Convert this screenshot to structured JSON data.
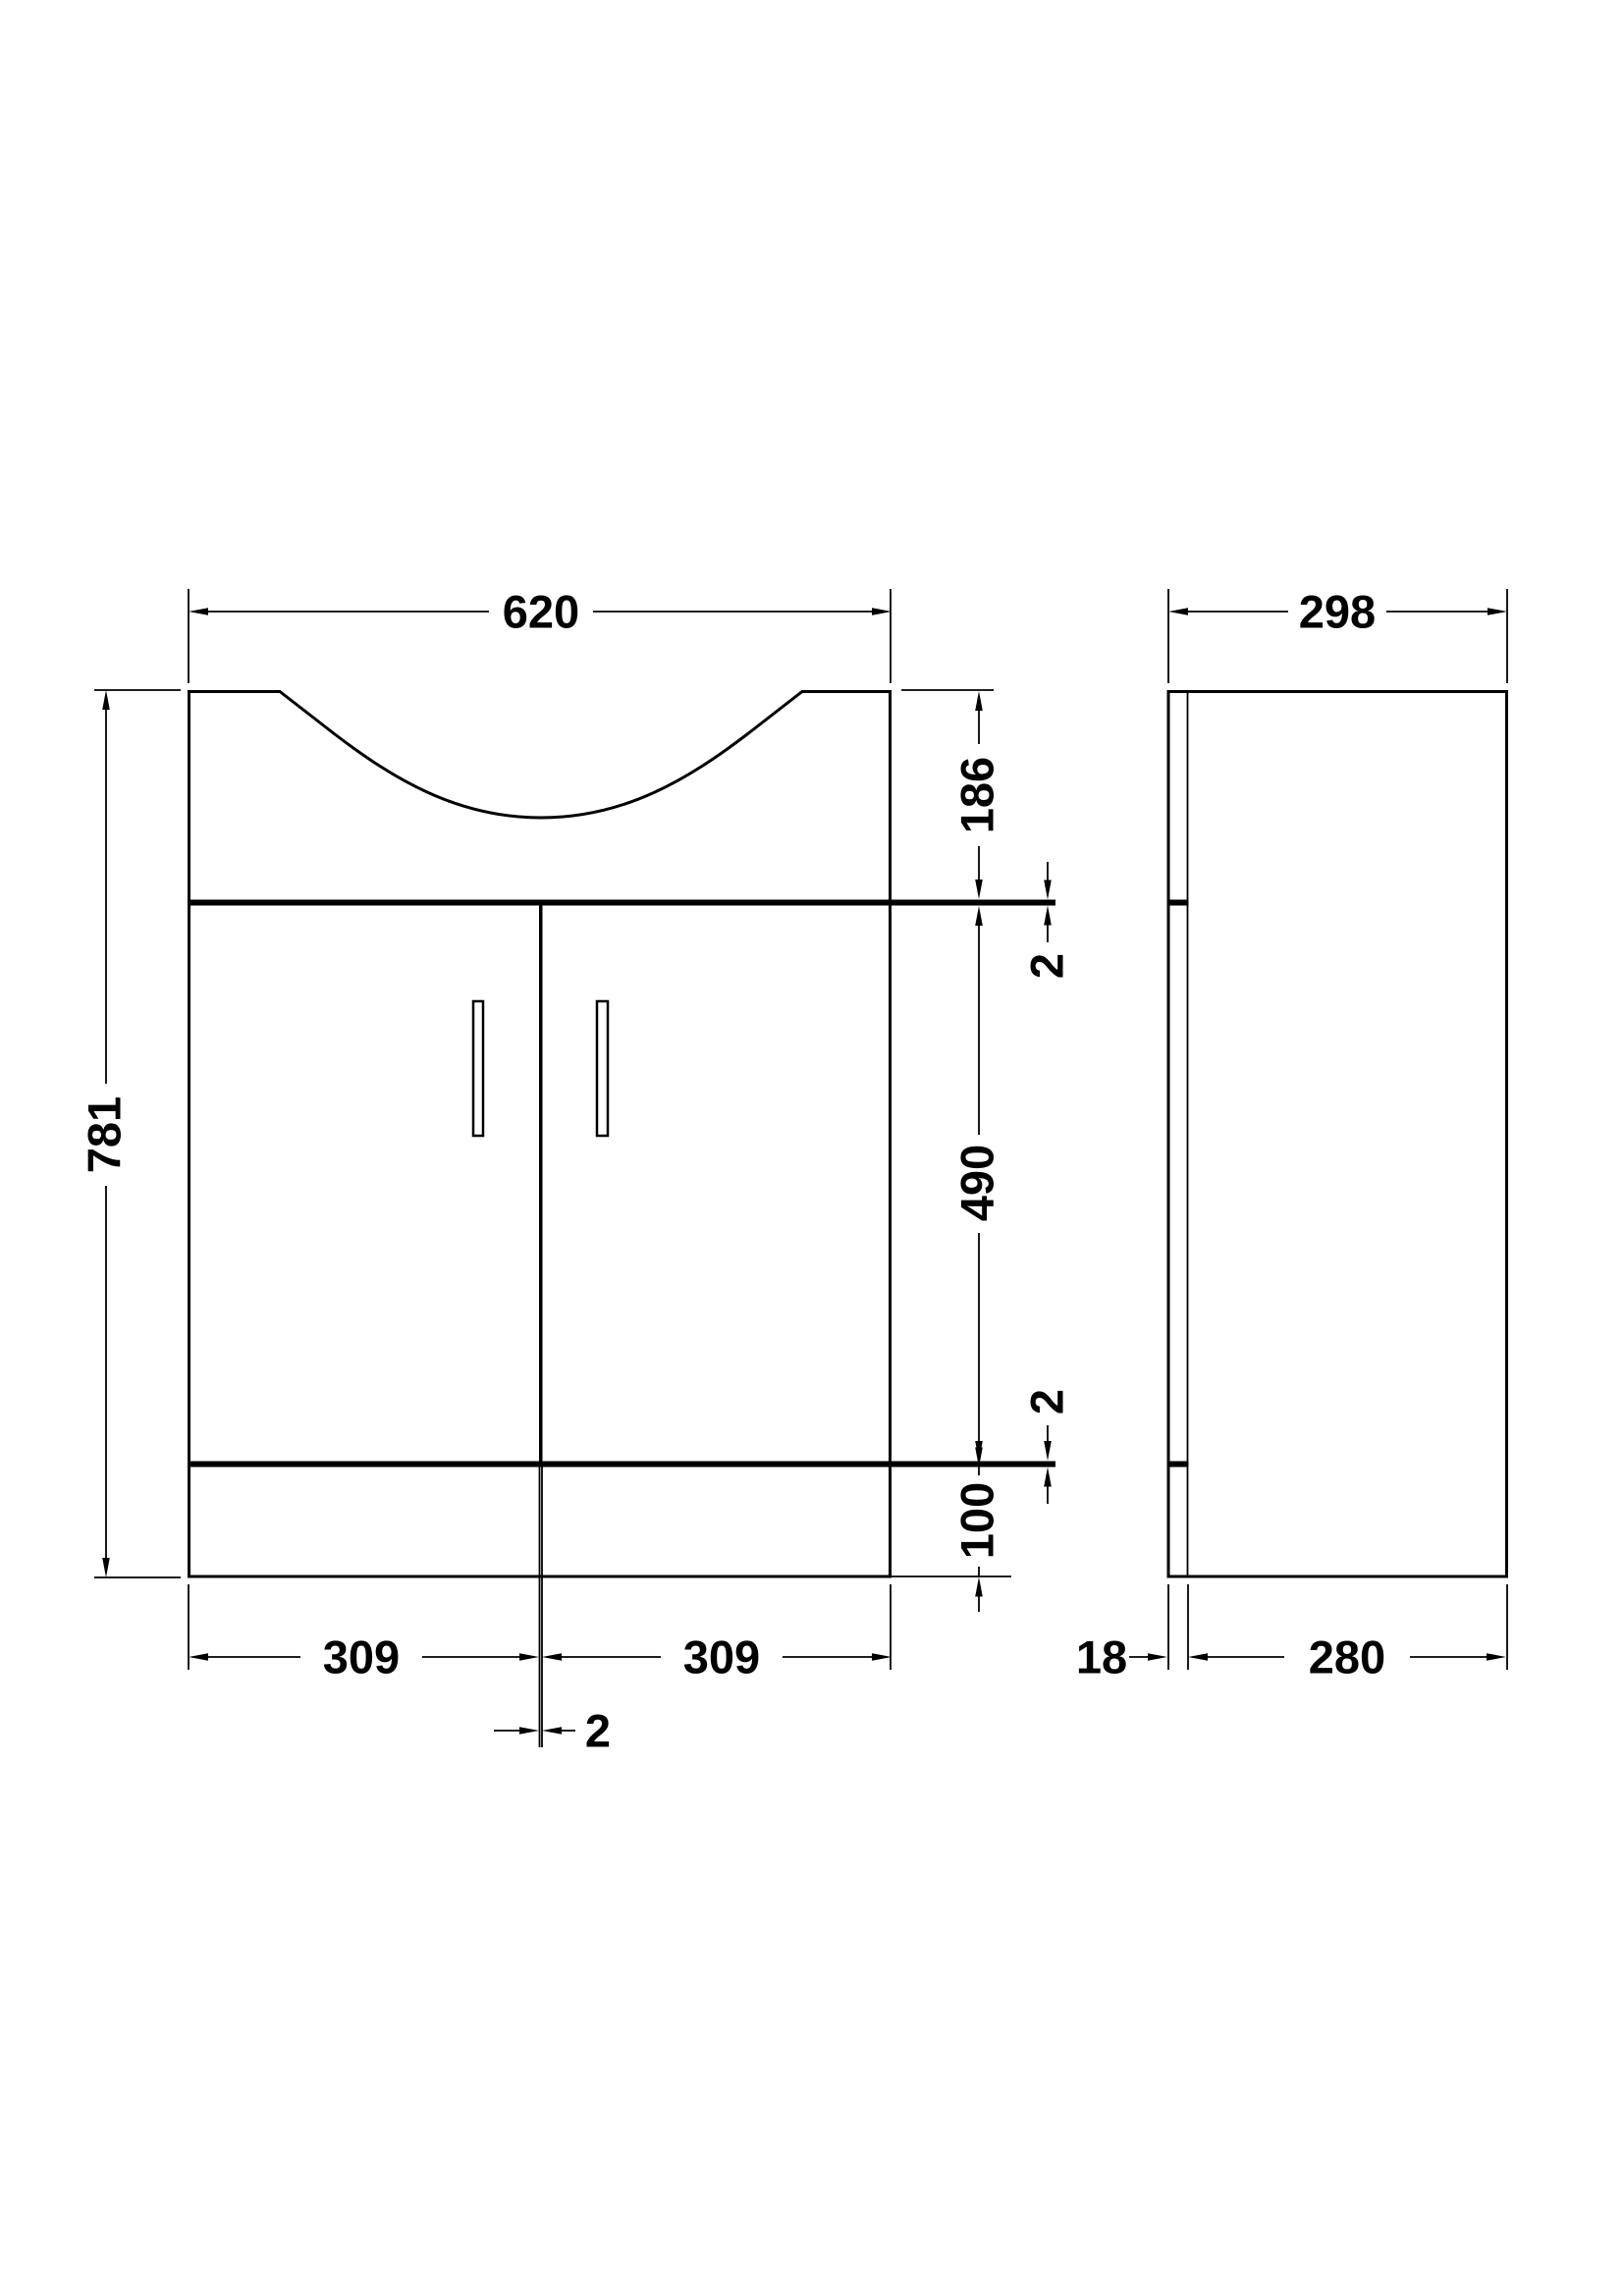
{
  "front_view": {
    "width_label": "620",
    "height_label": "781",
    "basin_height_label": "186",
    "counter_gap_label": "2",
    "door_height_label": "490",
    "plinth_gap_label": "2",
    "plinth_height_label": "100",
    "left_door_width_label": "309",
    "right_door_width_label": "309",
    "door_gap_label": "2"
  },
  "side_view": {
    "depth_label": "298",
    "back_panel_label": "18",
    "body_depth_label": "280"
  },
  "colors": {
    "line": "#000000",
    "background": "#ffffff"
  }
}
